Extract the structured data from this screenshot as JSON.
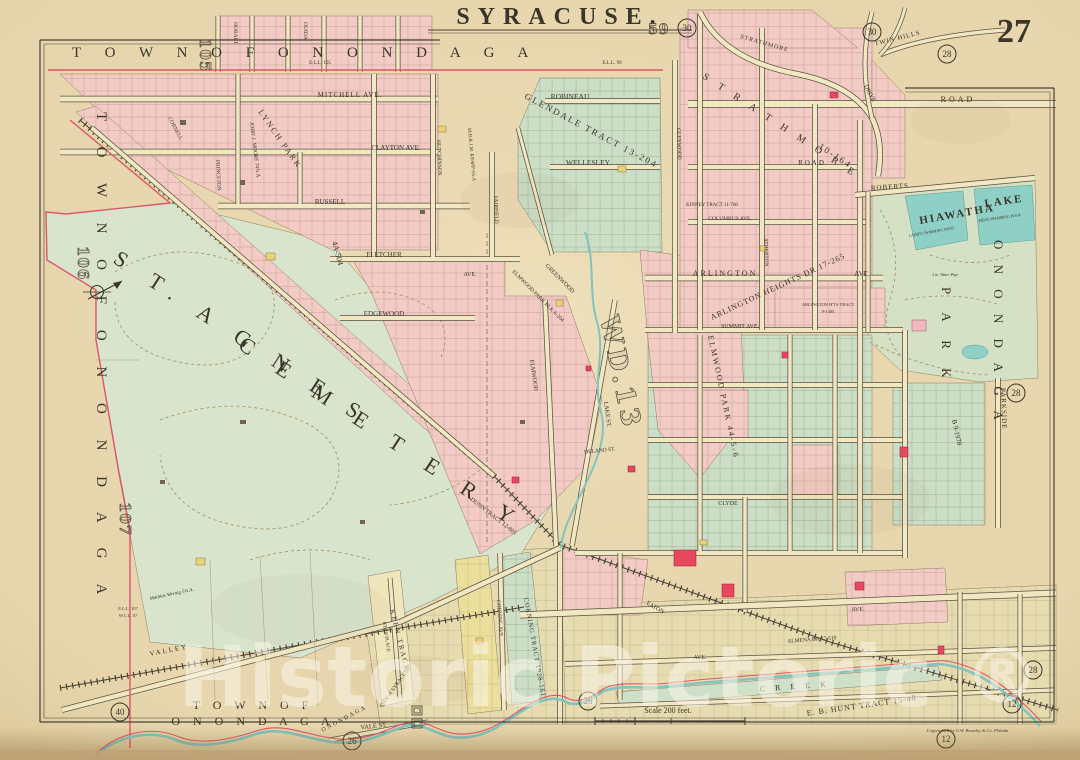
{
  "page": {
    "plate_number": "27",
    "title": "SYRACUSE.",
    "watermark_text": "Historic Pictoric",
    "watermark_mark": "®",
    "copyright": "Copyrighted by G.W. Bromley & Co. Philada.",
    "scale_label": "Scale 200 feet."
  },
  "town_labels": {
    "top": "T O W N   O F   O N O N D A G A",
    "left": "T O W N   O F   O N O N D A G A",
    "bottom_line1": "T O W N   O F",
    "bottom_line2": "O N O N D A G A"
  },
  "features": {
    "cemetery_1": "S T.  A G N E S",
    "cemetery_2": "C E M E T E R Y",
    "park_1": "O N O N D A G A",
    "park_2": "P A R K",
    "lake_1": "HIAWATHA",
    "lake_2": "LAKE",
    "ladies_pool": "LADIES SWIMMING POOL",
    "mens_pool": "MENS SWIMMING POOL",
    "water_pipe": "2 in. Water Pipe",
    "creek": "C R E E K",
    "creek_name": "ONONDAGA",
    "city": "CITY of SYRACUSE",
    "ward": "WD.13"
  },
  "tracts": {
    "glendale": "GLENDALE  TRACT  13-204",
    "kinney": "KINNEY TRACT 11-760",
    "strathmore1": "S T R A T H M O R E",
    "strathmore2": "10-164",
    "arlington_heights": "ARLINGTON HEIGHTS DR.17-265",
    "arlington_tract1": "ARLINGTON H'TS TRACT",
    "arlington_tract2": "9-1405",
    "elmwood_blk": "ELMWOOD PARK BLK 6-204",
    "elmwood_park_e": "ELMWOOD PARK 44-5-6",
    "dunn": "DUNN TRACT 12-805",
    "corning_tract": "CORNING TRACT 1928-161",
    "keen_tract": "KEEN  TRACT",
    "hunt": "E. B. HUNT TRACT 15-40",
    "almena": "ALMENA DR.17-510",
    "lynch1": "LYNCH PARK",
    "lynch2": "4A-504",
    "parkside_tract": "B 9-1978"
  },
  "estates": {
    "moore": "JOHN J. MOORE  74¾ A.",
    "knapp": "M.H.& J.M. KNAPP  6¾ A.",
    "mathias": "Mathias Wernig 5¾ A."
  },
  "streets": {
    "mitchell": "MITCHELL  AVE.",
    "clayton": "CLAYTON  AVE.",
    "russell": "RUSSELL",
    "fletcher": "FLETCHER",
    "edgewood": "EDGEWOOD",
    "hobart": "HOBART",
    "ouida": "OUIDA",
    "princeton": "PRINCETON",
    "hutchinson": "HUTCHINSON",
    "fairfield": "FAIRFIELD",
    "cornell": "CORNELL",
    "glenwood": "GLENWOOD",
    "robineau": "ROBINEAU",
    "wellesley": "WELLESLEY",
    "road1": "ROAD",
    "road2": "ROAD",
    "roberts": "ROBERTS",
    "columbus": "COLUMBUS  AVE.",
    "arlington": "ARLINGTON",
    "arlington_ave": "AVE.",
    "atherton": "ATHERTON",
    "summit": "SUMMIT  AVE.",
    "parkside": "PARKSIDE",
    "strathmore_drive1": "STRATHMORE",
    "strathmore_drive2": "DRIVE",
    "twin_hills": "TWIN  HILLS",
    "lake_st": "LAKE  ST.",
    "delano": "DELANO  ST.",
    "clyde": "CLYDE",
    "eaton": "EATON",
    "keen_place": "KEEN  PLACE",
    "corning_ave": "CORNING  AVE.",
    "valley": "VALLEY",
    "vale": "VALE  ST.",
    "ave1": "AVE.",
    "ave2": "AVE.",
    "ave3": "AVE.",
    "greenwood": "GREENWOOD",
    "elmwood_st": "ELMWOOD"
  },
  "boundary_notes": {
    "ell105": "E.L.L. 105",
    "ell99": "E.L.L. 99",
    "ell107": "E.L.L. 107",
    "wcl07": "W.C.L. 07"
  },
  "sections": {
    "s105": "105",
    "s106": "106",
    "s107": "107",
    "s59": "59"
  },
  "plate_refs": {
    "c30a": "30",
    "c30b": "30",
    "c28a": "28",
    "c28b": "28",
    "c28c": "28",
    "c12a": "12",
    "c12b": "12",
    "c26a": "26",
    "c26b": "26",
    "c40": "40"
  }
}
